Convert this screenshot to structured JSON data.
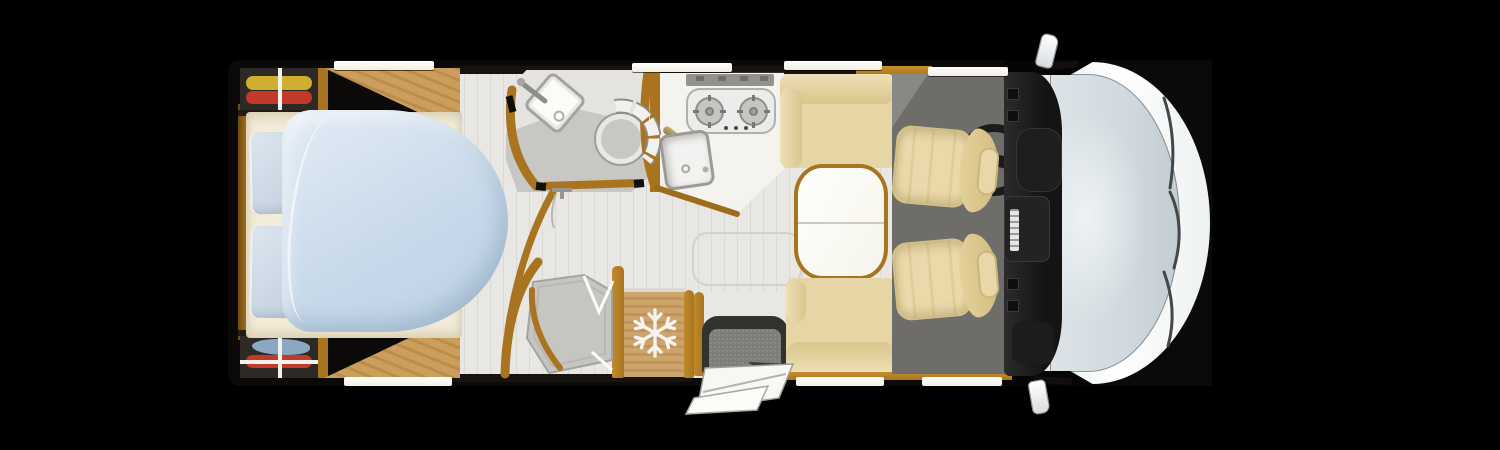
{
  "meta": {
    "title": "Motorhome floor plan — overhead view",
    "text_visible": false
  },
  "colors": {
    "black": "#000000",
    "gold": "#a8741f",
    "woodLight": "#cb9e5b",
    "woodDark": "#bb8d4c",
    "fridge1": "#cda469",
    "fridge2": "#c0945a",
    "floor": "#e8e7e3",
    "floorLine": "#dbd9d4",
    "bathFloor": "#e4e3df",
    "bathGrey": "#c9c7c3",
    "mat": "#6f6d6a",
    "beige": "#e6d5a5",
    "beigeLight": "#eee0b8",
    "beigeDark": "#d9c58c",
    "seat": "#ead9aa",
    "seatEdge": "#d4bf85",
    "duvet1": "#dfe9f4",
    "duvet2": "#c6d8e9",
    "sheet": "#f2ecd8",
    "pillow1": "#dde7f1",
    "pillow2": "#c3cfde",
    "wardrobe": "#2d2925",
    "clothesYellow": "#cfae2e",
    "clothesRed": "#c33a2b",
    "clothesBlue": "#8ca7c2",
    "glassEdge": "#c2ccd1",
    "windowStrip": "#fdfdf8",
    "steel": "#93918e",
    "white": "#ffffff"
  },
  "icons": {
    "freezer": "snowflake-icon"
  },
  "regions": {
    "bed": {
      "label": "Island bed with duvet and two pillows"
    },
    "wardrobeTop": {
      "label": "Rear wardrobe (yellow and red clothing)"
    },
    "wardrobeBottom": {
      "label": "Rear wardrobe (blue and red clothing)"
    },
    "washroom": {
      "label": "Washroom with corner basin and swivel toilet"
    },
    "shower": {
      "label": "Separate shower cabin"
    },
    "kitchen": {
      "label": "Kitchen with two-burner hob and sink"
    },
    "fridge": {
      "label": "Freezer / refrigerator cabinet"
    },
    "entry": {
      "label": "Entrance door with fold-out step"
    },
    "sofaFront": {
      "label": "Dinette bench seat (front wall)"
    },
    "sofaRear": {
      "label": "Dinette bench seat (rear wall)"
    },
    "table": {
      "label": "Dinette table"
    },
    "driverSeat": {
      "label": "Swivelled driver seat"
    },
    "passengerSeat": {
      "label": "Swivelled passenger seat"
    },
    "steeringWheel": {
      "label": "Steering wheel"
    },
    "dashboard": {
      "label": "Dashboard"
    },
    "windshield": {
      "label": "Windscreen with wipers"
    },
    "mirrors": {
      "label": "Exterior mirrors"
    }
  }
}
